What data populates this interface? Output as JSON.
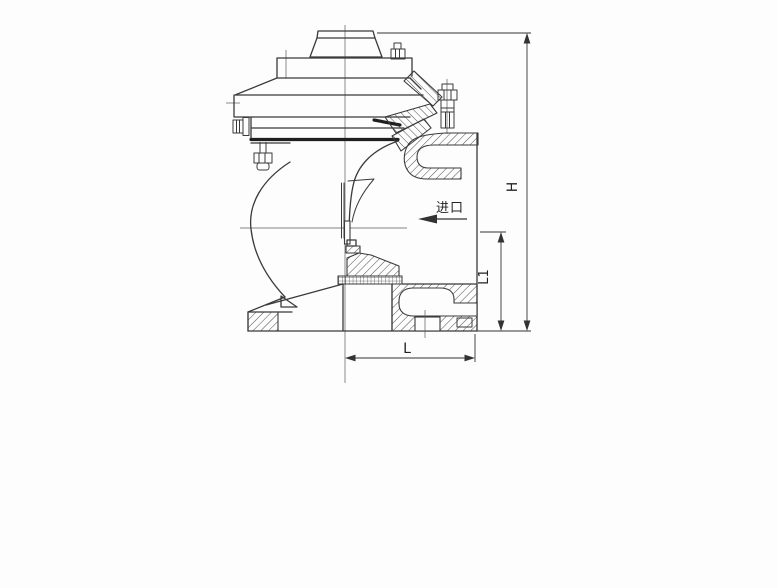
{
  "labels": {
    "dim_h": "H",
    "dim_l1": "L1",
    "dim_l": "L",
    "inlet": "进口"
  },
  "colors": {
    "background": "#fdfdfd",
    "line": "#3a3a3a",
    "dimension_line": "#333333"
  }
}
